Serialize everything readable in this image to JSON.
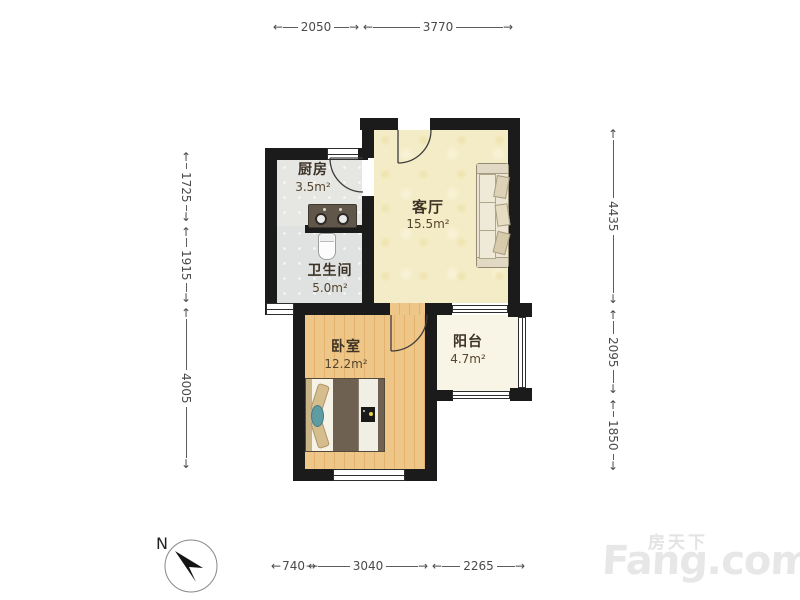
{
  "rooms": {
    "kitchen": {
      "name": "厨房",
      "area": "3.5m²"
    },
    "living": {
      "name": "客厅",
      "area": "15.5m²"
    },
    "bathroom": {
      "name": "卫生间",
      "area": "5.0m²"
    },
    "bedroom": {
      "name": "卧室",
      "area": "12.2m²"
    },
    "balcony": {
      "name": "阳台",
      "area": "4.7m²"
    }
  },
  "dimensions": {
    "top": [
      "2050",
      "3770"
    ],
    "left": [
      "1725",
      "1915",
      "4005"
    ],
    "right": [
      "4435",
      "2095",
      "1850"
    ],
    "bottom": [
      "740",
      "3040",
      "2265"
    ]
  },
  "compass": {
    "label": "N"
  },
  "watermark": {
    "chinese": "房天下",
    "brand": "Fang.com"
  },
  "colors": {
    "wall": "#1b1b1b",
    "living_floor": "#f4ecc6",
    "bedroom_floor": "#eec687",
    "kitchen_floor": "#e6e6e3",
    "bathroom_floor": "#e0e2e1",
    "balcony_floor": "#f8f4e6",
    "dimension_text": "#4a4a4a",
    "watermark_gray": "#e5e5e5"
  }
}
